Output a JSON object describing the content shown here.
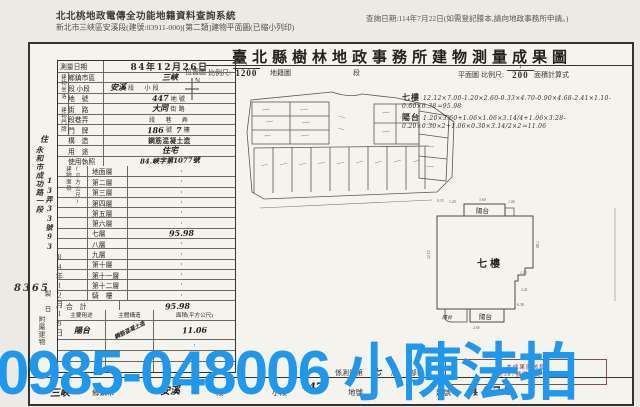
{
  "header": {
    "system_line1": "北北桃地政電傳全功能地籍資料查詢系統",
    "system_line2": "新北市三峽區安溪段(建號:03911-000)[第二類]建物平面圖(已縮小列印)",
    "query_date": "查詢日期:114年7月22日(如需登記謄本,請向地政事務所申請。)"
  },
  "form": {
    "title": "臺北縣樹林地政事務所建物測量成果圖",
    "north_label": "N",
    "scale": {
      "loc_label": "位置圖",
      "ratio_label": "比例尺:",
      "loc_num": "1",
      "loc_den": "1200",
      "after_loc": "地籍圖",
      "duan": "段",
      "plan_label": "平面圖",
      "plan_ratio_label": "比例尺:",
      "plan_num": "1",
      "plan_den": "200",
      "calc_label": "面積計算式"
    }
  },
  "table": {
    "strips": {
      "siting": "建物坐落",
      "address": "建物門牌",
      "area1": "建物面積",
      "area2": "(平方公尺)",
      "attached": "附屬建物"
    },
    "info_rows": [
      {
        "label": "測量日期",
        "value": "84年12月26日"
      },
      {
        "label": "鄉鎮市區",
        "value": "三峽"
      },
      {
        "label": "段 小段",
        "value": "安溪",
        "suffix": "段　小段"
      },
      {
        "label": "地　號",
        "value": "447",
        "suffix": "地號"
      },
      {
        "label": "街　路",
        "value": "大同",
        "suffix": "街路"
      },
      {
        "label": "段巷弄",
        "suffix": "段　巷　弄"
      },
      {
        "label": "門　牌",
        "value": "186",
        "mid": "號",
        "value2": "7",
        "suffix": "樓"
      },
      {
        "label": "構　造",
        "value": "鋼筋混凝土造"
      },
      {
        "label": "用　途",
        "value": "住宅"
      },
      {
        "label": "使用執照",
        "value": "84.峽字第1077號"
      }
    ],
    "floor_rows": [
      {
        "label": "地面層",
        "value": "·"
      },
      {
        "label": "第二層",
        "value": "·"
      },
      {
        "label": "第三層",
        "value": "·"
      },
      {
        "label": "第四層",
        "value": "·"
      },
      {
        "label": "第五層",
        "value": "·"
      },
      {
        "label": "第六層",
        "value": "·"
      },
      {
        "label": "七層",
        "value": "95.98"
      },
      {
        "label": "八層",
        "value": "·"
      },
      {
        "label": "九層",
        "value": "·"
      },
      {
        "label": "第十層",
        "value": "·"
      },
      {
        "label": "第十一層",
        "value": "·"
      },
      {
        "label": "第十二層",
        "value": "·"
      },
      {
        "label": "騎　樓",
        "value": "·"
      },
      {
        "label": "合　計",
        "value": "95.98"
      }
    ],
    "attached": {
      "headers": [
        "主要用途",
        "主體構造",
        "面積(平方公尺)"
      ],
      "rows": [
        {
          "use": "陽台",
          "structure": "鋼筋混凝土造",
          "area": "11.06"
        },
        {
          "use": "",
          "structure": "",
          "area": "·"
        },
        {
          "use": "一",
          "structure": "",
          "area": "·"
        },
        {
          "use": "",
          "structure": "",
          "area": "·"
        }
      ]
    }
  },
  "margin": {
    "char_top": "住",
    "note1": "永和市成功路一段",
    "note2": "13弄33號93",
    "stamp_no": "8365",
    "stamp_date": "84年12月19日",
    "small": "製 日"
  },
  "calc": {
    "floor_label": "七樓",
    "floor_formula": "12.12×7.00-1.20×2.60-0.33×4.70-0.90×4.68-2.41×1.10-0.60×6.38＝95.98",
    "balcony_label": "陽台",
    "balcony_formula": "1.20×3.60+1.06×1.06×3.14/4+1.06×3.28-0.20×0.30×2+1.06×0.30×3.14/2×2＝11.06"
  },
  "plan": {
    "label": "七樓",
    "balcony_top": "陽台",
    "balcony_bottom": "陽台",
    "balcony_bottom_left": "陽台",
    "dims": {
      "d1": "1.20",
      "d2": "3.60",
      "d3": "1.06",
      "d4": "12.12",
      "d5": "7.00",
      "d6": "2.41",
      "d7": "1.10",
      "d8": "6.38",
      "d9": "0.33",
      "d10": "2.60"
    }
  },
  "bottom": {
    "township_value": "三峽",
    "township_label": "鄉鎮市",
    "section_value": "安溪",
    "section_label": "段",
    "small_section": "小段",
    "lot_value": "447",
    "lot_label": "地號",
    "bldg_label": "建號",
    "bldg_no": "4479",
    "survey_note_pre": "係測量第",
    "survey_floor": "七",
    "survey_mid": "層",
    "survey_suf": "部份",
    "stamp_line1": "本成果圖核發",
    "stamp_line2": "字第387號規定免予校核"
  },
  "watermark": {
    "text": "0985-048006 小陳法拍",
    "color": "#1e97ef"
  }
}
